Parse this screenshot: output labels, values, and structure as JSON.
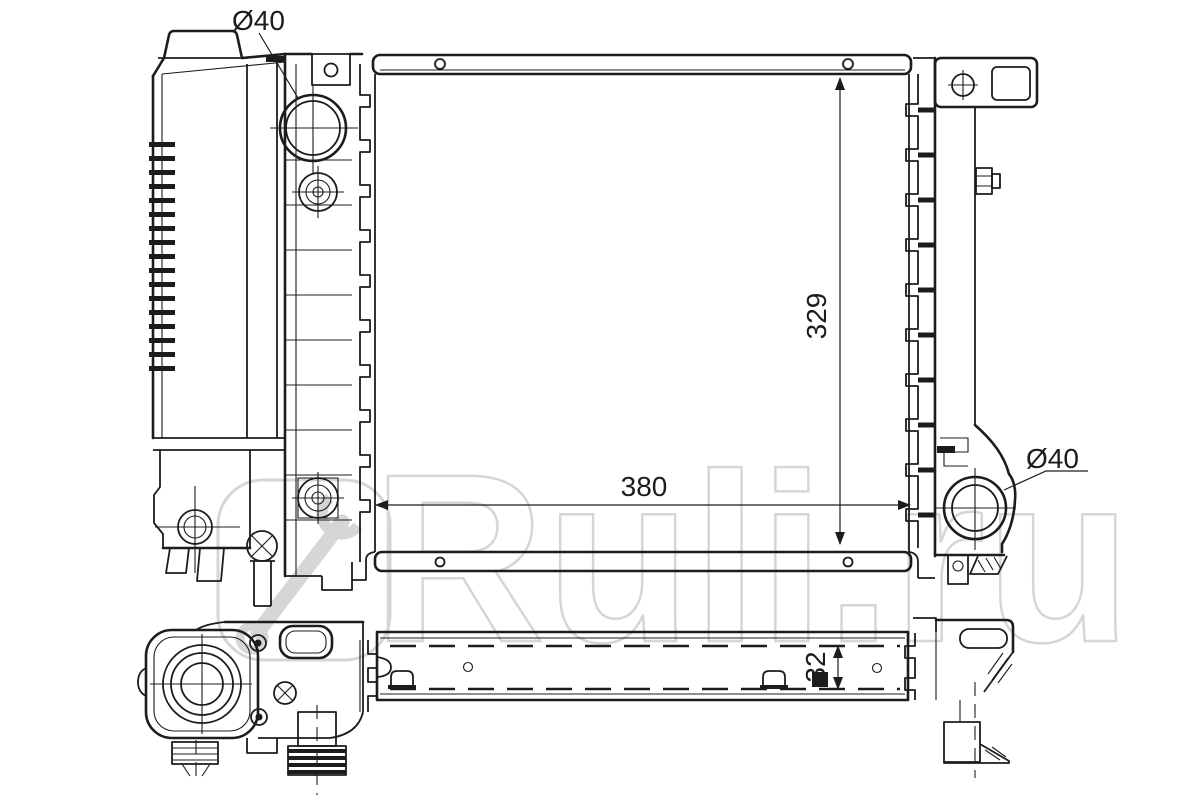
{
  "drawing": {
    "type": "technical line drawing",
    "subject": "Automotive radiator - front view and bottom view",
    "line_color": "#1c1c1c",
    "background": "#ffffff",
    "labels": {
      "inlet_diameter": "Ø40",
      "outlet_diameter": "Ø40",
      "core_height_mm": "329",
      "core_width_mm": "380",
      "core_depth_mm": "32"
    },
    "watermark": {
      "text": "Ruli.ru",
      "color": "#d6d6d6"
    }
  }
}
